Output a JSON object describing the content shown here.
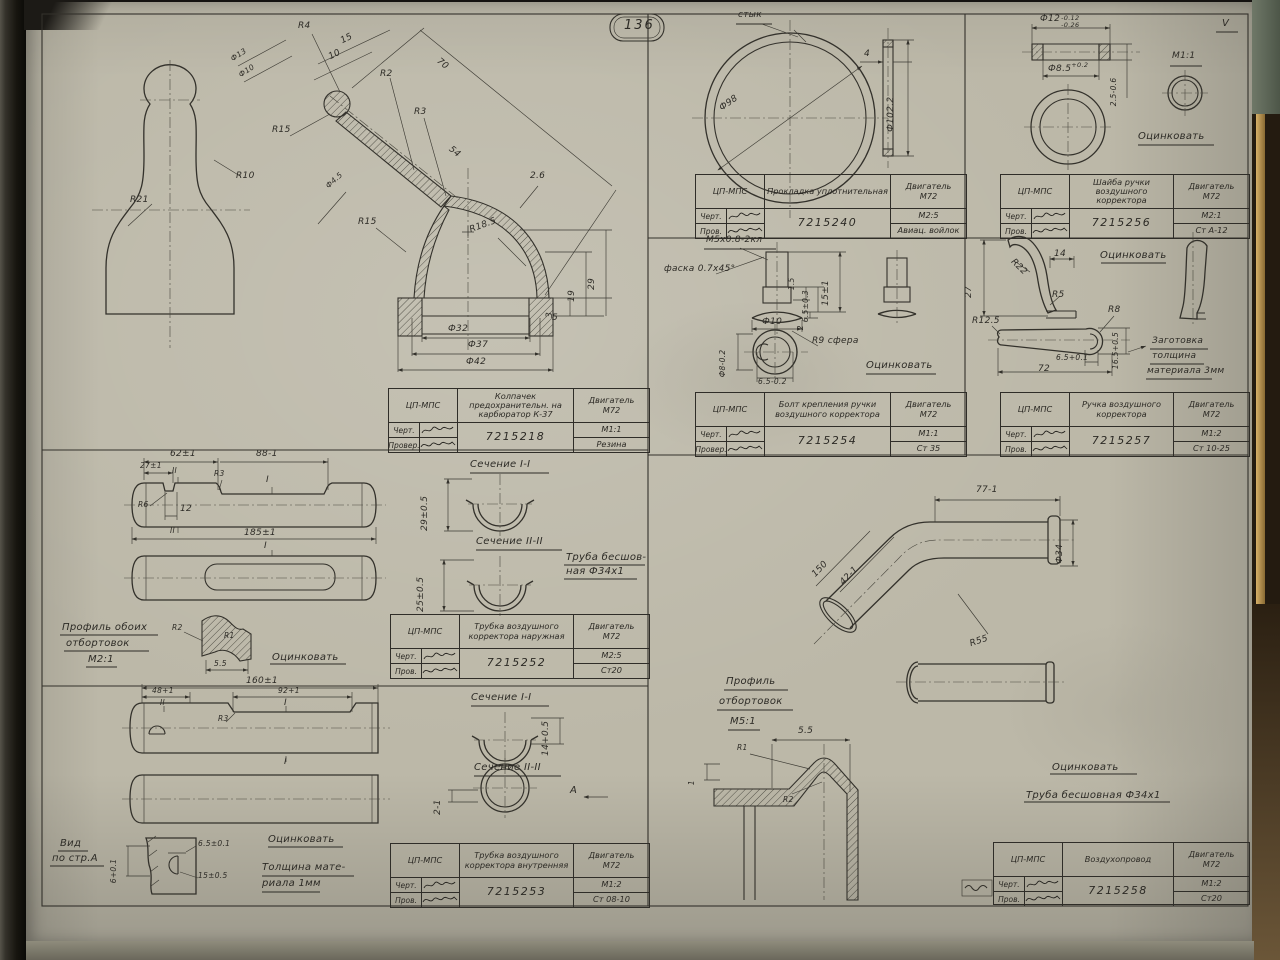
{
  "page": {
    "number": "136",
    "sheet_mark": "V"
  },
  "title_blocks": [
    {
      "org": "ЦП-МПС",
      "name": "Колпачек предохранительн. на карбюратор К-37",
      "engine": "Двигатель",
      "engine2": "М72",
      "chert": "Черт.",
      "prov": "Провер.",
      "number": "7215218",
      "scale": "М1:1",
      "material": "Резина"
    },
    {
      "org": "ЦП-МПС",
      "name": "Прокладка уплотнительная",
      "engine": "Двигатель",
      "engine2": "М72",
      "chert": "Черт.",
      "prov": "Пров.",
      "number": "7215240",
      "scale": "М2:5",
      "material": "Авиац. войлок"
    },
    {
      "org": "ЦП-МПС",
      "name": "Шайба ручки воздушного корректора",
      "engine": "Двигатель",
      "engine2": "М72",
      "chert": "Черт.",
      "prov": "Пров.",
      "number": "7215256",
      "scale": "М2:1",
      "material": "Ст А-12"
    },
    {
      "org": "ЦП-МПС",
      "name": "Болт крепления ручки воздушного корректора",
      "engine": "Двигатель",
      "engine2": "М72",
      "chert": "Черт.",
      "prov": "Провер.",
      "number": "7215254",
      "scale": "М1:1",
      "material": "Ст 35"
    },
    {
      "org": "ЦП-МПС",
      "name": "Ручка воздушного корректора",
      "engine": "Двигатель",
      "engine2": "М72",
      "chert": "Черт.",
      "prov": "Пров.",
      "number": "7215257",
      "scale": "М1:2",
      "material": "Ст 10-25"
    },
    {
      "org": "ЦП-МПС",
      "name": "Трубка воздушного корректора наружная",
      "engine": "Двигатель",
      "engine2": "М72",
      "chert": "Черт.",
      "prov": "Пров.",
      "number": "7215252",
      "scale": "М2:5",
      "material": "Ст20"
    },
    {
      "org": "ЦП-МПС",
      "name": "Трубка воздушного корректора внутренняя",
      "engine": "Двигатель",
      "engine2": "М72",
      "chert": "Черт.",
      "prov": "Пров.",
      "number": "7215253",
      "scale": "М1:2",
      "material": "Ст 08-10"
    },
    {
      "org": "ЦП-МПС",
      "name": "Воздухопровод",
      "engine": "Двигатель",
      "engine2": "М72",
      "chert": "Черт.",
      "prov": "Пров.",
      "number": "7215258",
      "scale": "М1:2",
      "material": "Ст20"
    }
  ],
  "ann": {
    "d1": [
      "R4",
      "15",
      "10",
      "R2",
      "70",
      "R3",
      "Ф13",
      "Ф10",
      "R15",
      "54",
      "2.6",
      "R15",
      "R18.5",
      "Ф4.5",
      "Ф32",
      "Ф37",
      "Ф42",
      "5",
      "3",
      "19",
      "29",
      "R10",
      "R21"
    ],
    "d2": [
      "стык",
      "Ф98",
      "4",
      "Ф102.2"
    ],
    "d3": [
      "М1:1",
      "Оцинковать",
      "2.5-0.6"
    ],
    "d3t": {
      "od": "Ф12",
      "od1": "-0.12",
      "od2": "-0.26",
      "idm": "Ф8.5",
      "id1": "+0.2"
    },
    "d4": [
      "М5х0.8-2кл",
      "фаска 0.7х45°",
      "1.5",
      "6.5±0.3",
      "15±1",
      "2",
      "Ф10",
      "Ф8-0.2",
      "6.5-0.2",
      "R9 сфера",
      "Оцинковать"
    ],
    "d5": [
      "R22",
      "14",
      "27",
      "R5",
      "Оцинковать",
      "R12.5",
      "R8",
      "6.5+0.1",
      "72",
      "16.5+0.5",
      "Заготовка",
      "толщина",
      "материала 3мм"
    ],
    "d6": [
      "62±1",
      "88-1",
      "27±1",
      "II",
      "R3",
      "I",
      "R6",
      "12",
      "185±1",
      "II",
      "I",
      "Сечение I-I",
      "29±0.5",
      "Сечение II-II",
      "25±0.5",
      "Труба бесшов-",
      "ная Ф34х1",
      "Профиль обоих",
      "отбортовок",
      "М2:1",
      "R2",
      "5.5",
      "Оцинковать",
      "R1"
    ],
    "d7": [
      "160±1",
      "48+1",
      "92+1",
      "R3",
      "II",
      "I",
      "I",
      "Сечение I-I",
      "14+0.5",
      "Сечение II-II",
      "2-1",
      "А",
      "Вид",
      "по стр.А",
      "6+0.1",
      "6.5±0.1",
      "15±0.5",
      "Оцинковать",
      "Толщина мате-",
      "риала 1мм"
    ],
    "d8": [
      "77-1",
      "150",
      "42-1",
      "R55",
      "Ф34",
      "Профиль",
      "отбортовок",
      "М5:1",
      "R1",
      "5.5",
      "R2",
      "1",
      "Оцинковать",
      "Труба бесшовная Ф34х1"
    ]
  }
}
